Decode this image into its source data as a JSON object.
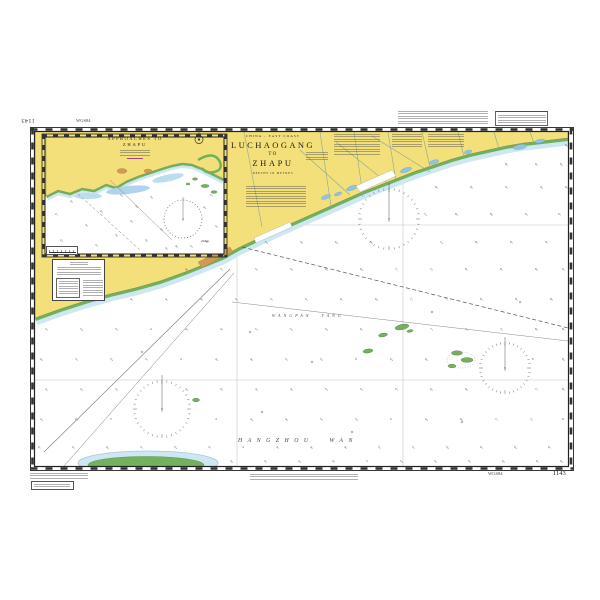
{
  "chart": {
    "sheet_number": "1143",
    "sheet_number_inverted": "1143",
    "horizontal_datum_top": "WGS84",
    "horizontal_datum_bottom": "WGS84",
    "title_block": {
      "region": "CHINA – EAST COAST",
      "title_line1": "LUCHAOGANG",
      "title_line2": "TO",
      "title_line3": "ZHAPU",
      "depths_note": "DEPTHS IN METRES"
    },
    "inset": {
      "title_line1": "APPROACHES TO",
      "title_line2": "ZHAPU"
    },
    "sea_labels": {
      "main_bay": "HANGZHOU WAN",
      "inner_bay": "WANGPAN YANG"
    },
    "town_label": "Zhapu",
    "colors": {
      "land": "#f4e07a",
      "intertidal_green": "#6fb15c",
      "shallow_blue": "#cfe7f3",
      "harbour_blue": "#8fc3e0",
      "shoal_green": "#74b15e",
      "town_brown": "#cf9a55",
      "note_accent": "#7d2d5e",
      "water": "#ffffff"
    },
    "soundings_main": [
      [
        565,
        146,
        "9.8"
      ],
      [
        505,
        165,
        "8.9"
      ],
      [
        535,
        165,
        "9.2"
      ],
      [
        560,
        165,
        "9.6"
      ],
      [
        435,
        188,
        "8.2"
      ],
      [
        470,
        188,
        "8.6"
      ],
      [
        505,
        188,
        "9.1"
      ],
      [
        540,
        188,
        "9.4"
      ],
      [
        565,
        188,
        "9.9"
      ],
      [
        424,
        215,
        "7.8"
      ],
      [
        455,
        215,
        "8.3"
      ],
      [
        490,
        215,
        "8.8"
      ],
      [
        525,
        215,
        "9.2"
      ],
      [
        558,
        215,
        "9.7"
      ],
      [
        265,
        243,
        "5.4"
      ],
      [
        300,
        243,
        "5.9"
      ],
      [
        335,
        243,
        "6.4"
      ],
      [
        370,
        243,
        "6.9"
      ],
      [
        440,
        243,
        "7.8"
      ],
      [
        475,
        243,
        "8.2"
      ],
      [
        510,
        243,
        "8.7"
      ],
      [
        545,
        243,
        "9.1"
      ],
      [
        185,
        270,
        "4.6"
      ],
      [
        220,
        270,
        "5.1"
      ],
      [
        255,
        270,
        "5.5"
      ],
      [
        290,
        270,
        "5.9"
      ],
      [
        325,
        270,
        "6.3"
      ],
      [
        360,
        270,
        "6.8"
      ],
      [
        395,
        270,
        "7.2"
      ],
      [
        430,
        270,
        "7.6"
      ],
      [
        465,
        270,
        "8.1"
      ],
      [
        500,
        270,
        "8.5"
      ],
      [
        535,
        270,
        "8.9"
      ],
      [
        562,
        270,
        "9.3"
      ],
      [
        95,
        300,
        "3.8"
      ],
      [
        130,
        300,
        "4.2"
      ],
      [
        165,
        300,
        "4.5"
      ],
      [
        200,
        300,
        "4.9"
      ],
      [
        235,
        300,
        "5.3"
      ],
      [
        270,
        300,
        "5.7"
      ],
      [
        305,
        300,
        "6.1"
      ],
      [
        340,
        300,
        "6.5"
      ],
      [
        375,
        300,
        "6.9"
      ],
      [
        410,
        300,
        "7.3"
      ],
      [
        445,
        300,
        "7.7"
      ],
      [
        480,
        300,
        "8.1"
      ],
      [
        515,
        300,
        "8.5"
      ],
      [
        550,
        300,
        "8.9"
      ],
      [
        45,
        330,
        "3.1"
      ],
      [
        80,
        330,
        "3.4"
      ],
      [
        115,
        330,
        "3.7"
      ],
      [
        150,
        330,
        "4"
      ],
      [
        185,
        330,
        "4.3"
      ],
      [
        220,
        330,
        "4.7"
      ],
      [
        255,
        330,
        "5.1"
      ],
      [
        290,
        330,
        "5.5"
      ],
      [
        325,
        330,
        "5.9"
      ],
      [
        360,
        330,
        "6.3"
      ],
      [
        430,
        330,
        "7.1"
      ],
      [
        465,
        330,
        "7.5"
      ],
      [
        500,
        330,
        "7.9"
      ],
      [
        535,
        330,
        "8.3"
      ],
      [
        562,
        330,
        "8.7"
      ],
      [
        40,
        360,
        "2.8"
      ],
      [
        75,
        360,
        "3.1"
      ],
      [
        110,
        360,
        "3.4"
      ],
      [
        145,
        360,
        "3.7"
      ],
      [
        180,
        360,
        "4"
      ],
      [
        215,
        360,
        "4.4"
      ],
      [
        250,
        360,
        "4.8"
      ],
      [
        285,
        360,
        "5.2"
      ],
      [
        320,
        360,
        "5.6"
      ],
      [
        355,
        360,
        "6"
      ],
      [
        390,
        360,
        "6.4"
      ],
      [
        425,
        360,
        "6.8"
      ],
      [
        532,
        360,
        "8"
      ],
      [
        562,
        360,
        "8.4"
      ],
      [
        45,
        390,
        "2.6"
      ],
      [
        80,
        390,
        "2.9"
      ],
      [
        115,
        390,
        "3.2"
      ],
      [
        185,
        390,
        "3.8"
      ],
      [
        220,
        390,
        "4.1"
      ],
      [
        255,
        390,
        "4.5"
      ],
      [
        290,
        390,
        "4.9"
      ],
      [
        325,
        390,
        "5.3"
      ],
      [
        360,
        390,
        "5.7"
      ],
      [
        395,
        390,
        "6.1"
      ],
      [
        430,
        390,
        "6.5"
      ],
      [
        465,
        390,
        "6.9"
      ],
      [
        535,
        390,
        "7.7"
      ],
      [
        562,
        390,
        "8.1"
      ],
      [
        40,
        420,
        "2.4"
      ],
      [
        75,
        420,
        "2.7"
      ],
      [
        110,
        420,
        "3"
      ],
      [
        215,
        420,
        "4"
      ],
      [
        250,
        420,
        "4.4"
      ],
      [
        285,
        420,
        "4.8"
      ],
      [
        320,
        420,
        "5.2"
      ],
      [
        355,
        420,
        "5.6"
      ],
      [
        390,
        420,
        "6"
      ],
      [
        425,
        420,
        "6.4"
      ],
      [
        460,
        420,
        "6.8"
      ],
      [
        495,
        420,
        "7.2"
      ],
      [
        530,
        420,
        "7.6"
      ],
      [
        562,
        420,
        "8"
      ],
      [
        38,
        448,
        "2.2"
      ],
      [
        72,
        448,
        "2.5"
      ],
      [
        106,
        448,
        "2.8"
      ],
      [
        140,
        448,
        "3.1"
      ],
      [
        174,
        448,
        "3.4"
      ],
      [
        208,
        448,
        "3.7"
      ],
      [
        242,
        448,
        "4"
      ],
      [
        276,
        448,
        "4.3"
      ],
      [
        310,
        448,
        "4.6"
      ],
      [
        344,
        448,
        "4.9"
      ],
      [
        378,
        448,
        "5.2"
      ],
      [
        412,
        448,
        "5.5"
      ],
      [
        446,
        448,
        "5.8"
      ],
      [
        480,
        448,
        "6.1"
      ],
      [
        514,
        448,
        "6.4"
      ],
      [
        548,
        448,
        "6.7"
      ],
      [
        230,
        462,
        "3.8"
      ],
      [
        264,
        462,
        "4.1"
      ],
      [
        298,
        462,
        "4.4"
      ],
      [
        332,
        462,
        "4.7"
      ],
      [
        366,
        462,
        "5"
      ],
      [
        400,
        462,
        "5.3"
      ],
      [
        434,
        462,
        "5.6"
      ],
      [
        468,
        462,
        "5.9"
      ],
      [
        502,
        462,
        "6.2"
      ],
      [
        536,
        462,
        "6.5"
      ],
      [
        560,
        462,
        "6.8"
      ]
    ],
    "soundings_inset": [
      [
        55,
        215,
        "2.1"
      ],
      [
        70,
        202,
        "2.6"
      ],
      [
        85,
        226,
        "3.2"
      ],
      [
        100,
        212,
        "2.9"
      ],
      [
        115,
        236,
        "3.6"
      ],
      [
        130,
        222,
        "4.1"
      ],
      [
        145,
        241,
        "3.8"
      ],
      [
        160,
        230,
        "4.4"
      ],
      [
        175,
        247,
        "4.9"
      ],
      [
        205,
        242,
        "5.6"
      ],
      [
        215,
        227,
        "5.9"
      ],
      [
        60,
        241,
        "2.4"
      ],
      [
        95,
        246,
        "3.1"
      ],
      [
        135,
        207,
        "3.4"
      ],
      [
        120,
        196,
        "3.3"
      ],
      [
        150,
        198,
        "3.9"
      ],
      [
        210,
        196,
        "5.1"
      ],
      [
        165,
        249,
        "4.5"
      ],
      [
        190,
        247,
        "5.2"
      ],
      [
        203,
        208,
        "4.8"
      ]
    ]
  }
}
